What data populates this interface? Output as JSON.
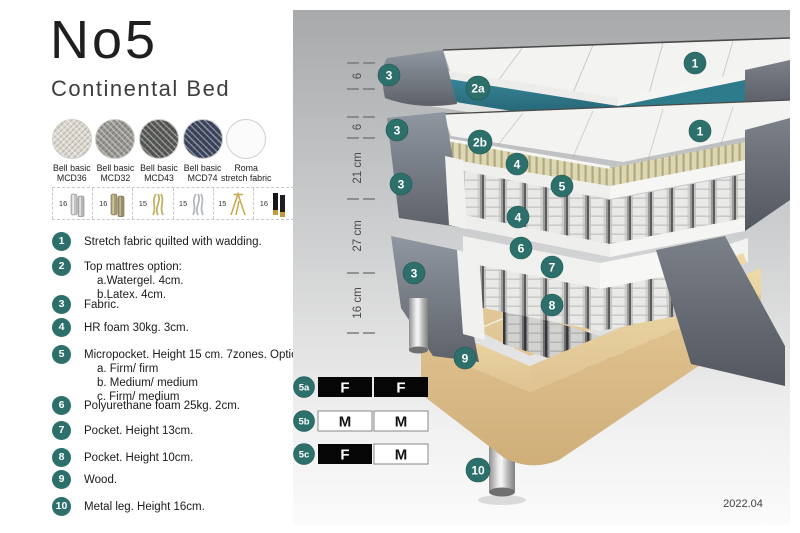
{
  "title": "No5",
  "subtitle": "Continental Bed",
  "fabrics": [
    {
      "line1": "Bell basic",
      "line2": "MCD36",
      "color": "#dcd8cf"
    },
    {
      "line1": "Bell basic",
      "line2": "MCD32",
      "color": "#97958f"
    },
    {
      "line1": "Bell basic",
      "line2": "MCD43",
      "color": "#575955"
    },
    {
      "line1": "Bell basic",
      "line2": "MCD74",
      "color": "#3c445e"
    },
    {
      "line1": "Roma",
      "line2": "stretch fabric",
      "color": "#fbfbfb"
    }
  ],
  "legs": [
    {
      "height": "16",
      "type": "cylinder silver"
    },
    {
      "height": "16",
      "type": "cylinder bronze"
    },
    {
      "height": "15",
      "type": "twisted gold"
    },
    {
      "height": "15",
      "type": "twisted silver"
    },
    {
      "height": "15",
      "type": "hairpin gold"
    },
    {
      "height": "16",
      "type": "black with gold tip"
    }
  ],
  "list": [
    {
      "num": "1",
      "text": "Stretch fabric quilted with wadding."
    },
    {
      "num": "2",
      "text": "Top mattres option:",
      "subs": [
        "a.Watergel. 4cm.",
        "b.Latex. 4cm."
      ]
    },
    {
      "num": "3",
      "text": "Fabric."
    },
    {
      "num": "4",
      "text": "HR foam 30kg. 3cm."
    },
    {
      "num": "5",
      "text": "Micropocket. Height 15 cm. 7zones. Option:",
      "subs": [
        "a. Firm/ firm",
        "b. Medium/ medium",
        "c. Firm/ medium"
      ]
    },
    {
      "num": "6",
      "text": "Polyurethane foam 25kg. 2cm."
    },
    {
      "num": "7",
      "text": "Pocket. Height 13cm."
    },
    {
      "num": "8",
      "text": "Pocket. Height 10cm."
    },
    {
      "num": "9",
      "text": "Wood."
    },
    {
      "num": "10",
      "text": "Metal leg. Height 16cm."
    }
  ],
  "diagram": {
    "scale_labels": [
      "6",
      "6",
      "21 cm",
      "27 cm",
      "16 cm"
    ],
    "badges": [
      "1",
      "3",
      "2a",
      "1",
      "3",
      "2b",
      "4",
      "3",
      "5",
      "4",
      "6",
      "7",
      "3",
      "8",
      "9",
      "10"
    ],
    "firmness": {
      "rows": [
        {
          "id": "5a",
          "cells": [
            {
              "label": "F",
              "variant": "dark"
            },
            {
              "label": "F",
              "variant": "dark"
            }
          ]
        },
        {
          "id": "5b",
          "cells": [
            {
              "label": "M",
              "variant": "light"
            },
            {
              "label": "M",
              "variant": "light"
            }
          ]
        },
        {
          "id": "5c",
          "cells": [
            {
              "label": "F",
              "variant": "dark"
            },
            {
              "label": "M",
              "variant": "light"
            }
          ]
        }
      ]
    },
    "version": "2022.04"
  },
  "colors": {
    "badge_teal": "#2d706b",
    "topper_teal": "#2e7b8c",
    "upholstery_gray": "#646a73",
    "latex_tan": "#d9d3ad",
    "wood": "#e6cb99"
  }
}
